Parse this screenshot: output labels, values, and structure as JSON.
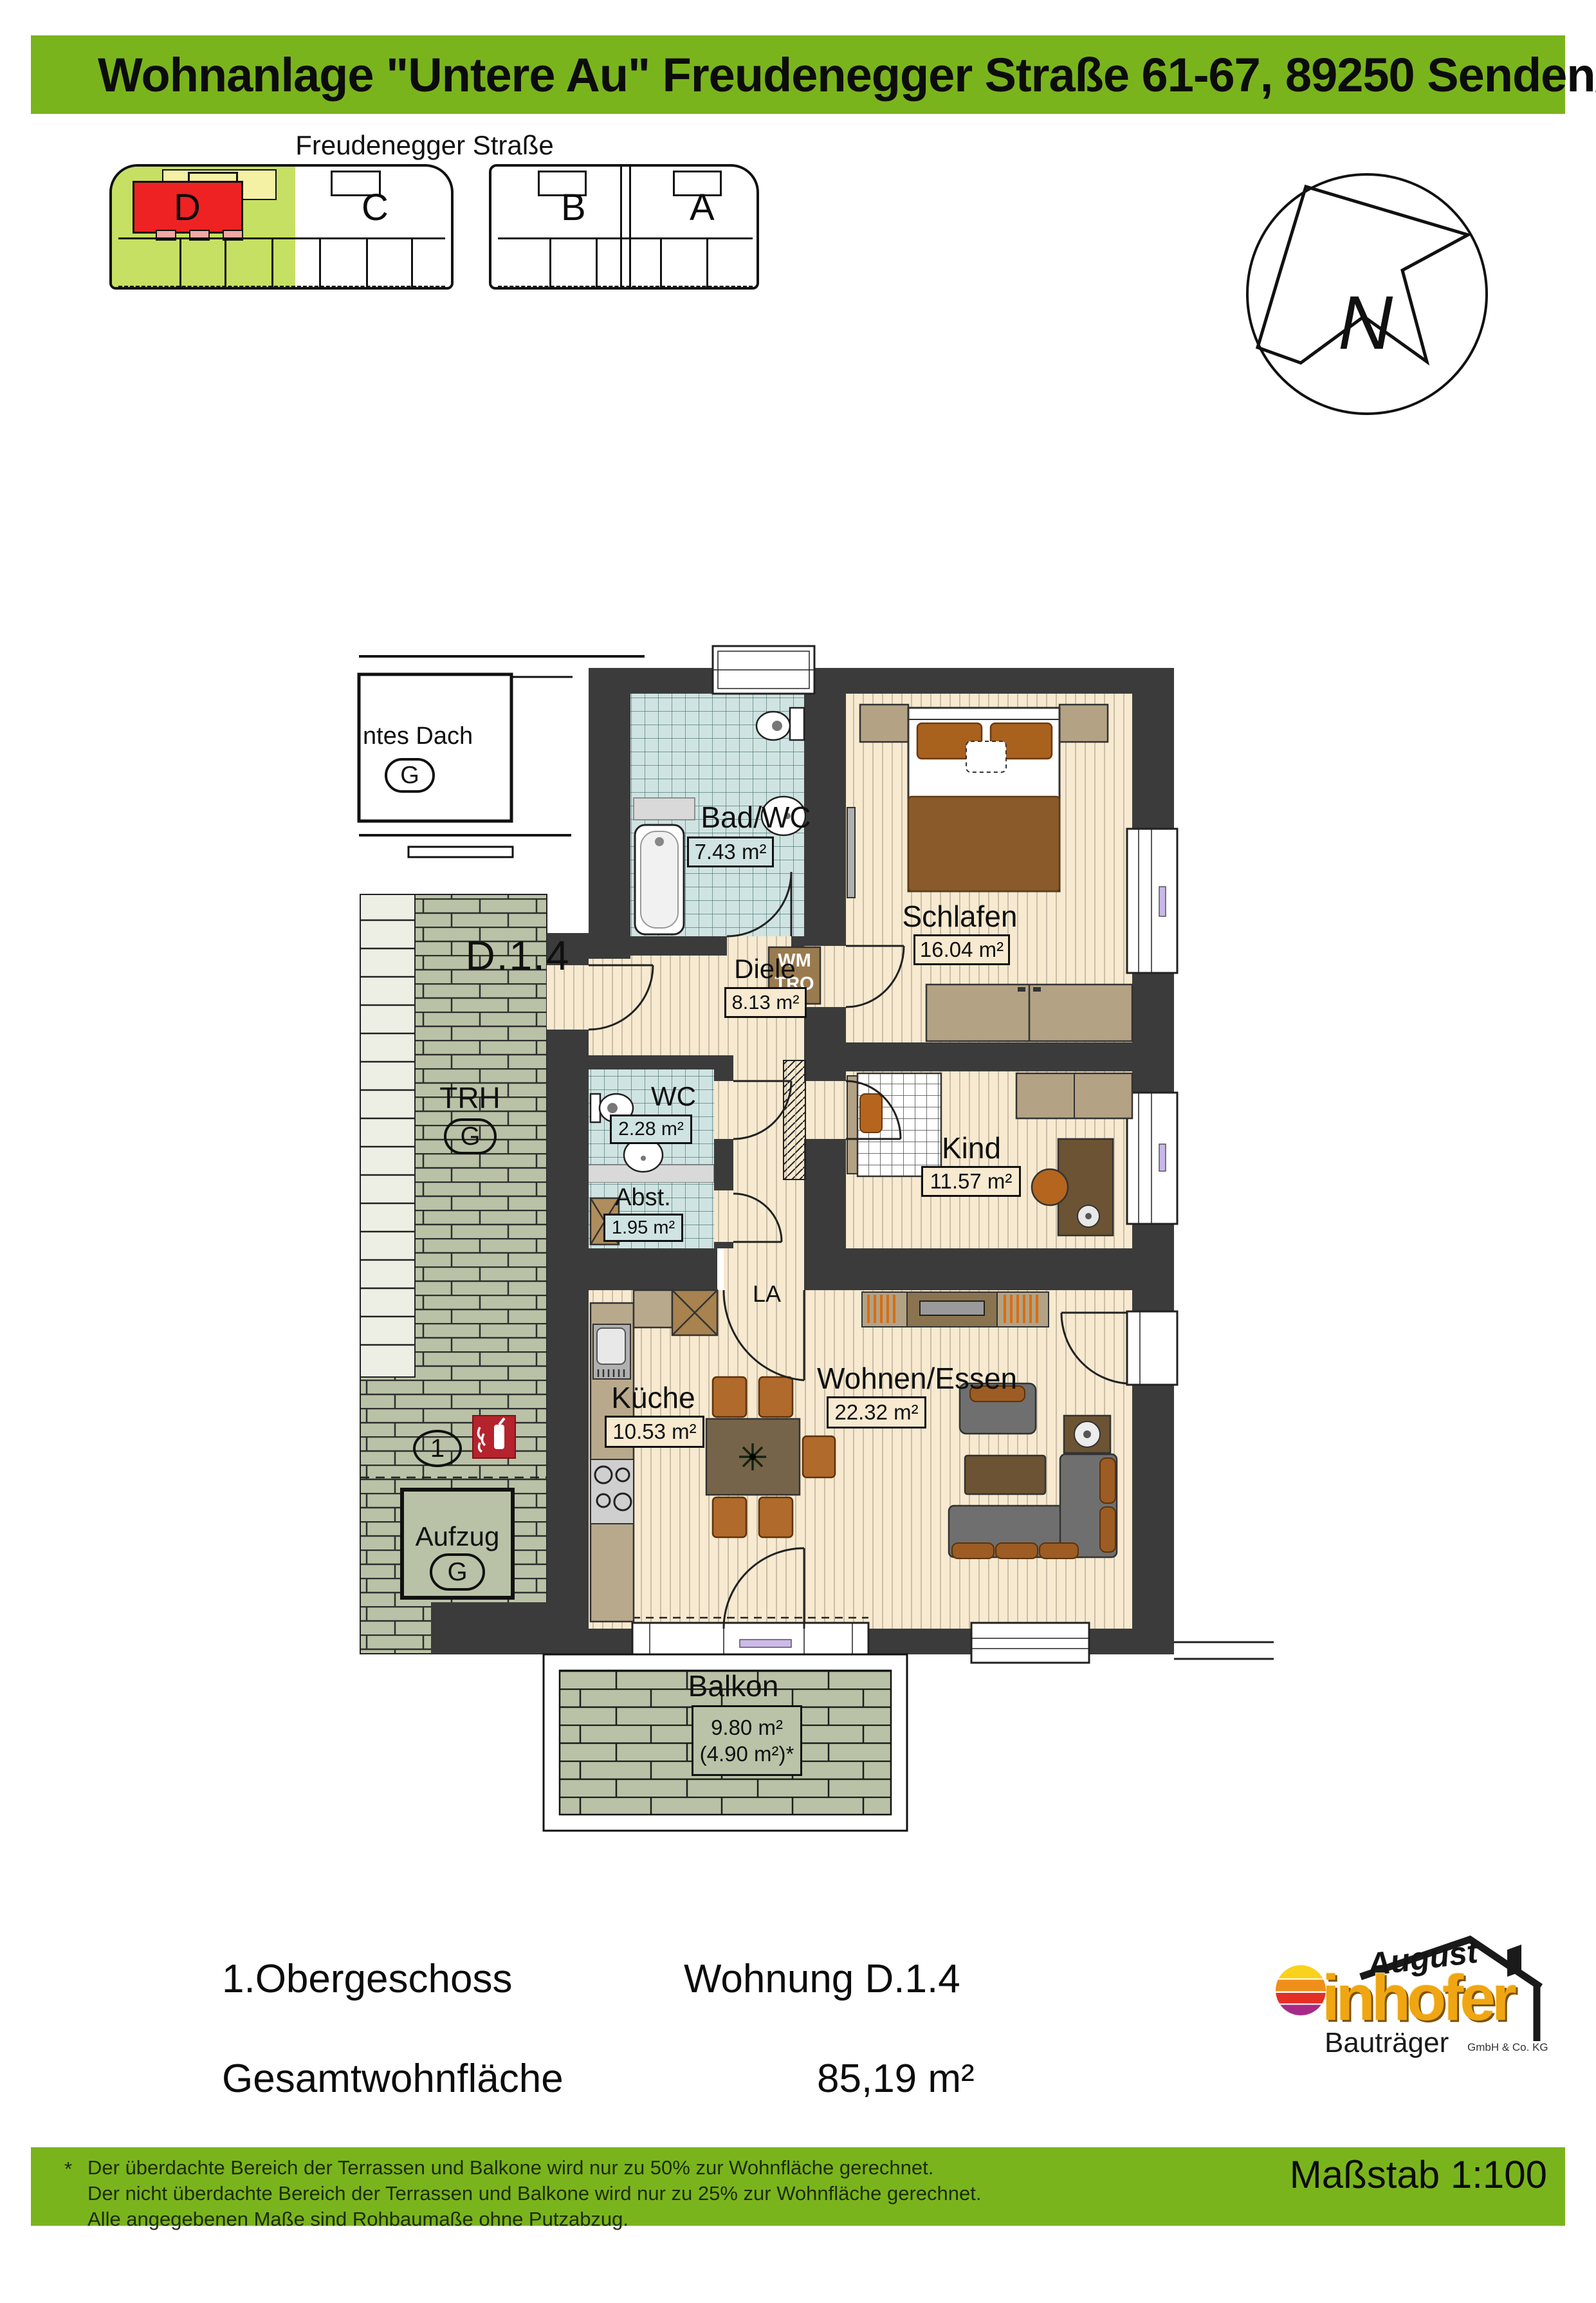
{
  "header": {
    "title": "Wohnanlage \"Untere Au\" Freudenegger Straße 61-67, 89250 Senden/Ay"
  },
  "site_plan": {
    "street": "Freudenegger Straße",
    "buildings": [
      "D",
      "C",
      "B",
      "A"
    ]
  },
  "north_label": "N",
  "plan": {
    "unit_label": "D.1.4",
    "adjacent": {
      "roof_label": "ntes Dach",
      "roof_tag": "G"
    },
    "stairwell": {
      "label": "TRH",
      "tag": "G"
    },
    "elevator": {
      "label": "Aufzug",
      "tag": "G"
    },
    "position_marker": "1",
    "appliances": {
      "wm": "WM",
      "tro": "TRO"
    },
    "vent": "LA",
    "rooms": {
      "bad": {
        "name": "Bad/WC",
        "area": "7.43 m²"
      },
      "schlafen": {
        "name": "Schlafen",
        "area": "16.04 m²"
      },
      "diele": {
        "name": "Diele",
        "area": "8.13 m²"
      },
      "wc": {
        "name": "WC",
        "area": "2.28 m²"
      },
      "abst": {
        "name": "Abst.",
        "area": "1.95 m²"
      },
      "kind": {
        "name": "Kind",
        "area": "11.57 m²"
      },
      "kueche": {
        "name": "Küche",
        "area": "10.53 m²"
      },
      "wohnen": {
        "name": "Wohnen/Essen",
        "area": "22.32 m²"
      },
      "balkon": {
        "name": "Balkon",
        "area": "9.80 m²",
        "area2": "(4.90 m²)*"
      }
    }
  },
  "info": {
    "floor": "1.Obergeschoss",
    "unit": "Wohnung D.1.4",
    "total_label": "Gesamtwohnfläche",
    "total_value": "85,19 m²"
  },
  "logo": {
    "top": "August",
    "main": "inhofer",
    "sub": "Bauträger",
    "suffix": "GmbH & Co. KG"
  },
  "footer": {
    "asterisk": "*",
    "lines": [
      "Der überdachte Bereich der Terrassen und Balkone wird nur zu 50% zur Wohnfläche gerechnet.",
      "Der nicht überdachte Bereich der Terrassen und Balkone wird nur zu 25% zur Wohnfläche gerechnet.",
      "Alle angegebenen Maße sind Rohbaumaße ohne Putzabzug."
    ],
    "scale": "Maßstab 1:100"
  },
  "colors": {
    "accent_green": "#7ab41d",
    "site_green": "#c6e063",
    "site_red": "#ee2222",
    "site_yellow": "#f4f0a4",
    "site_pink": "#f3a8a4",
    "wall": "#3b3b3b",
    "wood_floor": "#f7ead0",
    "tile_blue": "#cfe4e2",
    "tile_green": "#b9c2a6"
  }
}
